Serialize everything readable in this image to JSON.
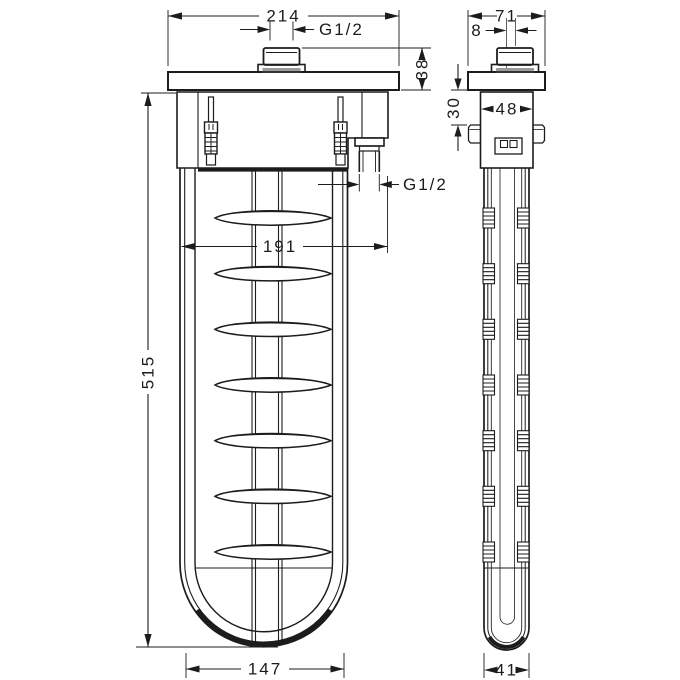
{
  "drawing": {
    "kind": "technical-dimension-drawing",
    "views": {
      "front": "front view",
      "side": "side view"
    }
  },
  "colors": {
    "line": "#1c1c1c",
    "shade": "#9a9a9a",
    "background": "#ffffff"
  },
  "dims": {
    "front_overall_width": "214",
    "front_top_thread": "G1/2",
    "front_flange_height": "38",
    "front_overall_height": "515",
    "front_outlet_span": "191",
    "front_outlet_thread": "G1/2",
    "front_body_width": "147",
    "side_overall_width": "71",
    "side_thread_offset": "8",
    "side_flange_depth": "30",
    "side_body_depth": "48",
    "side_tube_depth": "41"
  }
}
